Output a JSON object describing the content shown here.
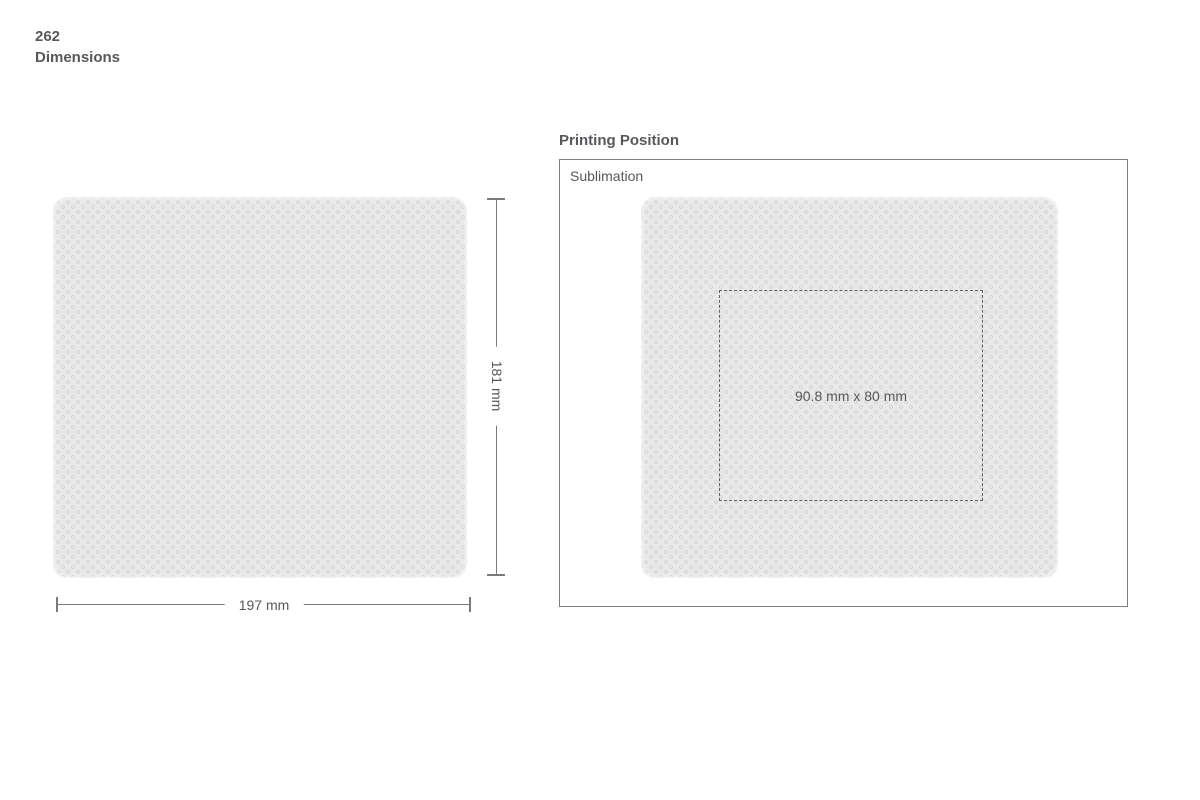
{
  "page": {
    "number": "262",
    "title": "Dimensions"
  },
  "dimensions": {
    "width_label": "197 mm",
    "height_label": "181 mm"
  },
  "printing_position": {
    "title": "Printing Position",
    "method_label": "Sublimation",
    "print_area_label": "90.8 mm x 80 mm"
  },
  "colors": {
    "text": "#57585b",
    "dim_line": "#7a7a7a",
    "pad_base": "#e9e9e9",
    "pad_dot": "#d6d6d6",
    "panel_border": "#7d7d7d",
    "dash_border": "#606060",
    "background": "#ffffff"
  }
}
